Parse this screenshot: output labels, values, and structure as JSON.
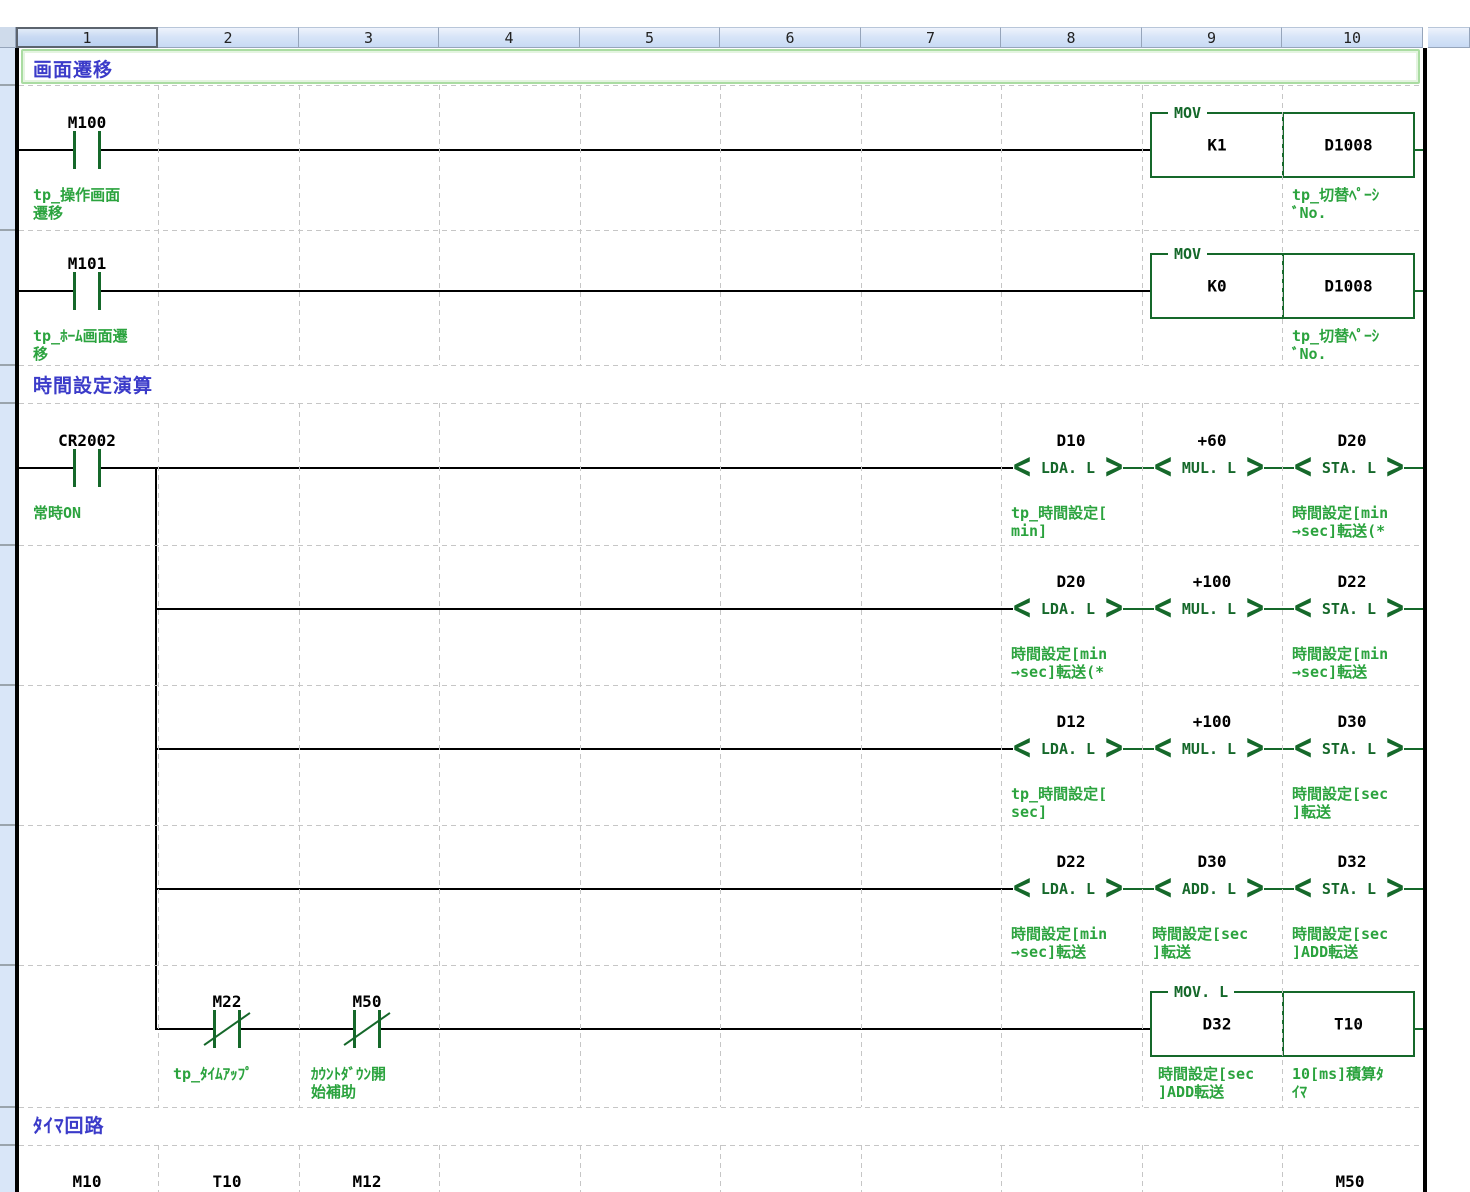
{
  "app": "ladder-editor",
  "colors": {
    "instruction_green": "#15682a",
    "comment_green": "#2ba33e",
    "section_blue": "#3b3bc9",
    "header_fill": "#cfe0f6",
    "grid_gray": "#c6c6c6"
  },
  "header": {
    "columns": [
      "1",
      "2",
      "3",
      "4",
      "5",
      "6",
      "7",
      "8",
      "9",
      "10"
    ]
  },
  "sections": [
    {
      "label": "画面遷移"
    },
    {
      "label": "時間設定演算"
    },
    {
      "label": "ﾀｲﾏ回路"
    }
  ],
  "rungs": {
    "r1": {
      "contact": {
        "label": "M100",
        "comment": "tp_操作画面\n遷移"
      },
      "box": {
        "label": "MOV",
        "src": "K1",
        "dst": "D1008",
        "dst_comment": "tp_切替ﾍﾟｰｼ\nﾞNo."
      }
    },
    "r2": {
      "contact": {
        "label": "M101",
        "comment": "tp_ﾎｰﾑ画面遷\n移"
      },
      "box": {
        "label": "MOV",
        "src": "K0",
        "dst": "D1008",
        "dst_comment": "tp_切替ﾍﾟｰｼ\nﾞNo."
      }
    },
    "r3": {
      "contact": {
        "label": "CR2002",
        "comment": "常時ON"
      },
      "i1": {
        "operand": "D10",
        "op": "LDA. L",
        "comment": "tp_時間設定[\nmin]"
      },
      "i2": {
        "operand": "+60",
        "op": "MUL. L"
      },
      "i3": {
        "operand": "D20",
        "op": "STA. L",
        "comment": "時間設定[min\n→sec]転送(*"
      }
    },
    "r4": {
      "i1": {
        "operand": "D20",
        "op": "LDA. L",
        "comment": "時間設定[min\n→sec]転送(*"
      },
      "i2": {
        "operand": "+100",
        "op": "MUL. L"
      },
      "i3": {
        "operand": "D22",
        "op": "STA. L",
        "comment": "時間設定[min\n→sec]転送"
      }
    },
    "r5": {
      "i1": {
        "operand": "D12",
        "op": "LDA. L",
        "comment": "tp_時間設定[\nsec]"
      },
      "i2": {
        "operand": "+100",
        "op": "MUL. L"
      },
      "i3": {
        "operand": "D30",
        "op": "STA. L",
        "comment": "時間設定[sec\n]転送"
      }
    },
    "r6": {
      "i1": {
        "operand": "D22",
        "op": "LDA. L",
        "comment": "時間設定[min\n→sec]転送"
      },
      "i2": {
        "operand": "D30",
        "op": "ADD. L",
        "comment": "時間設定[sec\n]転送"
      },
      "i3": {
        "operand": "D32",
        "op": "STA. L",
        "comment": "時間設定[sec\n]ADD転送"
      }
    },
    "r7": {
      "c1": {
        "label": "M22",
        "comment": "tp_ﾀｲﾑｱｯﾌﾟ"
      },
      "c2": {
        "label": "M50",
        "comment": "ｶｳﾝﾄﾀﾞｳﾝ開\n始補助"
      },
      "box": {
        "label": "MOV. L",
        "src": "D32",
        "dst": "T10",
        "src_comment": "時間設定[sec\n]ADD転送",
        "dst_comment": "10[ms]積算ﾀ\nｲﾏ"
      }
    },
    "r8": {
      "c1": "M10",
      "c2": "T10",
      "c3": "M12",
      "c4": "M50"
    }
  }
}
